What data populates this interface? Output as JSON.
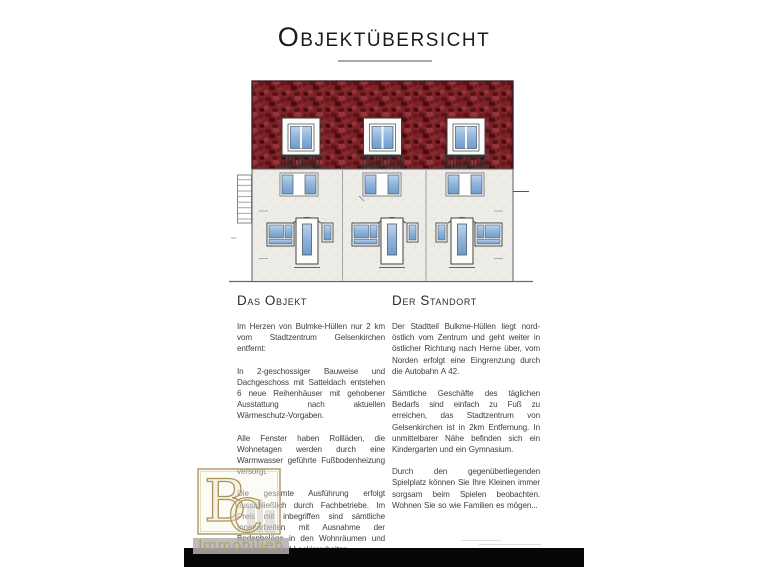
{
  "page": {
    "title": "Objektübersicht"
  },
  "illustration": {
    "name": "building-front-elevation-drawing",
    "units": 3,
    "colors": {
      "roof_red": "#7c2228",
      "window_blue": "#8fb3da",
      "facade_gray": "#edece7",
      "outline": "#4a4a4a"
    }
  },
  "columns": {
    "left": {
      "heading": "Das Objekt",
      "paragraphs": [
        "Im Herzen von Bulmke-Hüllen nur 2 km vom Stadtzentrum Gelsenkirchen entfernt:",
        "In 2-geschossiger Bauweise und Dachgeschoss mit Satteldach entstehen 6 neue Reihenhäuser mit gehobener Ausstattung nach aktuellen Wärmeschutz-Vorgaben.",
        "Alle Fenster haben Rollläden, die Wohnetagen werden durch eine Warmwasser geführte Fußbodenheizung versorgt.",
        "Die gesamte Ausführung erfolgt ausschließlich durch Fachbetriebe. Im Preis mit inbegriffen sind sämtliche Innenarbeiten mit Ausnahme der Bodenbeläge in den Wohnräumen und den Maler- und Lackierarbeiten."
      ]
    },
    "right": {
      "heading": "Der Standort",
      "paragraphs": [
        "Der Stadtteil Bulkme-Hüllen liegt nord-östlich vom Zentrum und geht weiter in östlicher Richtung nach Herne über, vom Norden erfolgt eine Eingrenzung durch die Autobahn A 42.",
        "Sämtliche Geschäfte des täglichen Bedarfs sind einfach zu Fuß zu erreichen, das Stadtzentrum von Gelsenkirchen ist in 2km Entfernung. In unmittelbarer Nähe befinden sich ein Kindergarten und ein Gymnasium.",
        "Durch den gegenüberliegenden Spielplatz können Sie Ihre Kleinen immer sorgsam beim Spielen beobachten. Wohnen Sie so wie Familien es mögen..."
      ]
    }
  },
  "watermark": {
    "monogram": "BC",
    "monogram_letters": [
      "B",
      "C"
    ],
    "label": "Immobilien",
    "gold": "#b3a06a"
  }
}
